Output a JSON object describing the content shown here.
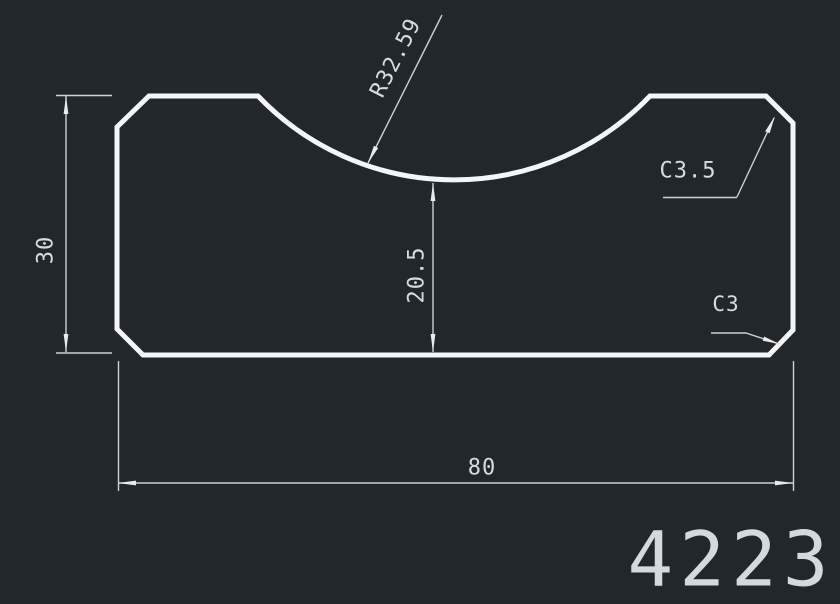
{
  "drawing": {
    "labels": {
      "radius": "R32.59",
      "overall_height": "30",
      "pocket_depth": "20.5",
      "chamfer_top_right": "C3.5",
      "chamfer_bottom_right": "C3",
      "overall_width": "80"
    },
    "part_number": "4223",
    "colors": {
      "background": "#22272c",
      "outline": "#f3f5f6",
      "dimension": "#ccd1d6",
      "text": "#d9dcdf"
    }
  }
}
